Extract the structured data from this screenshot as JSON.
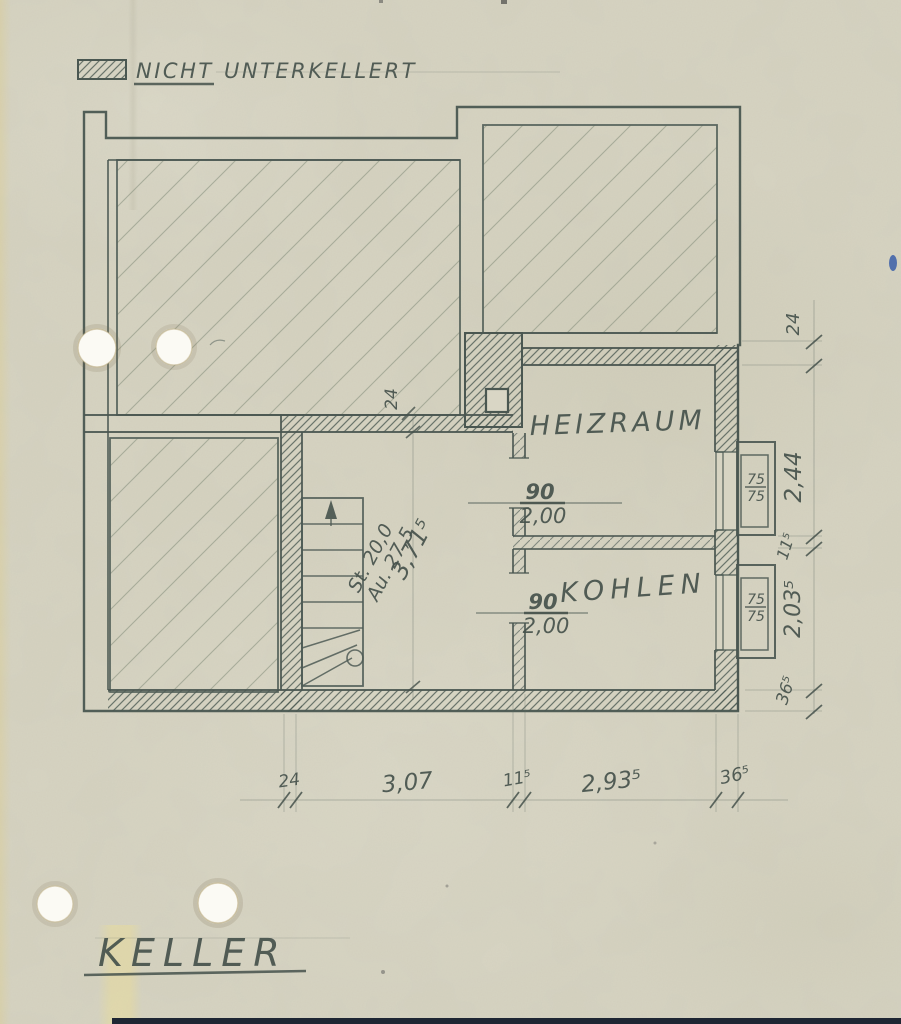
{
  "legend": {
    "nicht": "NICHT",
    "unterkellert": "UNTERKELLERT"
  },
  "title": {
    "text": "KELLER"
  },
  "rooms": {
    "heizraum": "HEIZRAUM",
    "kohlen": "KOHLEN"
  },
  "stair_note": {
    "riser": "St. 20,0",
    "tread": "Au. 27,5",
    "total": "3,71⁵"
  },
  "doors": {
    "heizraum": {
      "width": "90",
      "height": "2,00"
    },
    "kohlen": {
      "width": "90",
      "height": "2,00"
    }
  },
  "windows": {
    "heizraum": {
      "top": "75",
      "bottom": "75"
    },
    "kohlen": {
      "top": "75",
      "bottom": "75"
    }
  },
  "dims": {
    "bottom": [
      "24",
      "3,07",
      "11⁵",
      "2,93⁵",
      "36⁵"
    ],
    "right": [
      "24",
      "2,44",
      "11⁵",
      "2,03⁵",
      "36⁵"
    ],
    "stair_top": "24"
  },
  "colors": {
    "paper": "#d7d4c2",
    "pencil": "#4e5b55",
    "hole": "#fbfaf4",
    "bottom_edge": "#1e2633"
  }
}
